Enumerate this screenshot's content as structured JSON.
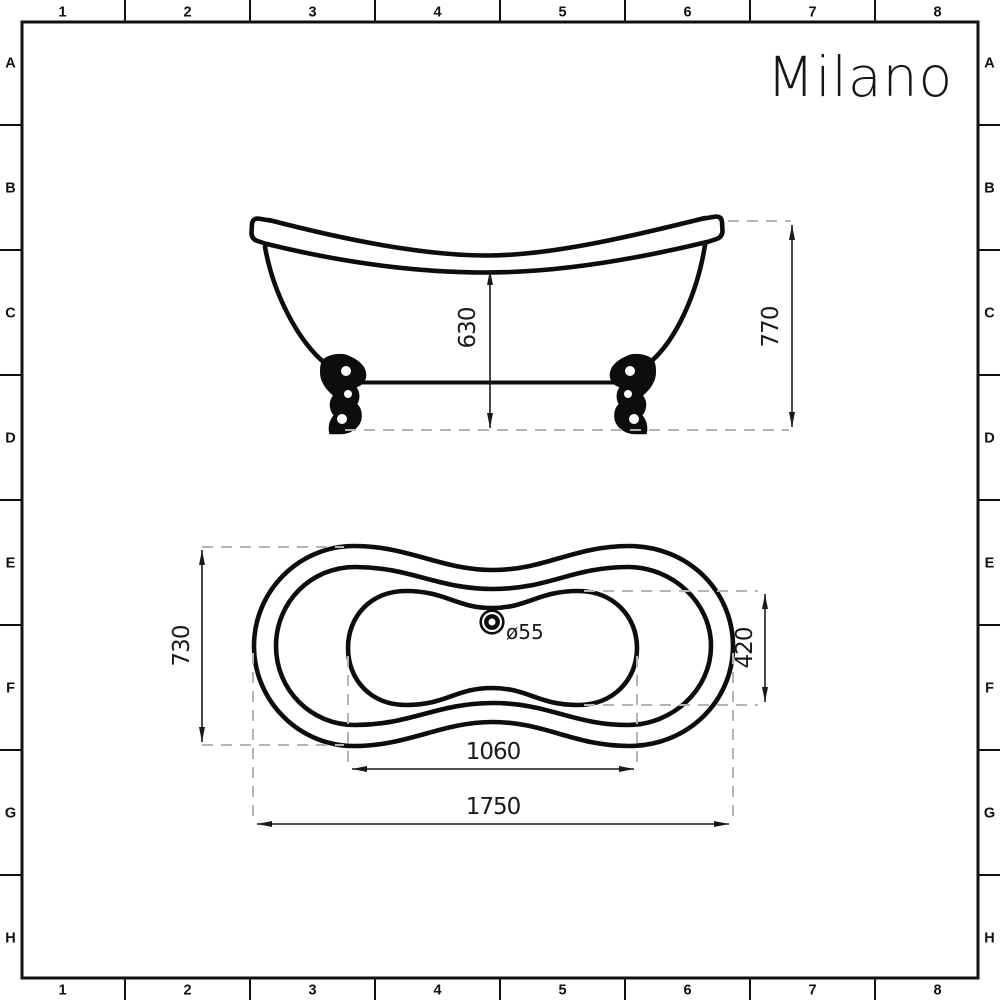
{
  "brand": "Milano",
  "grid": {
    "columns": [
      "1",
      "2",
      "3",
      "4",
      "5",
      "6",
      "7",
      "8"
    ],
    "rows": [
      "A",
      "B",
      "C",
      "D",
      "E",
      "F",
      "G",
      "H"
    ]
  },
  "side_view": {
    "inner_height": "630",
    "overall_height": "770"
  },
  "plan_view": {
    "overall_width": "730",
    "basin_width": "420",
    "basin_length": "1060",
    "overall_length": "1750",
    "drain_diameter": "ø55"
  },
  "colors": {
    "line": "#111111",
    "dash_gray": "#b3b3b3",
    "background": "#ffffff"
  }
}
